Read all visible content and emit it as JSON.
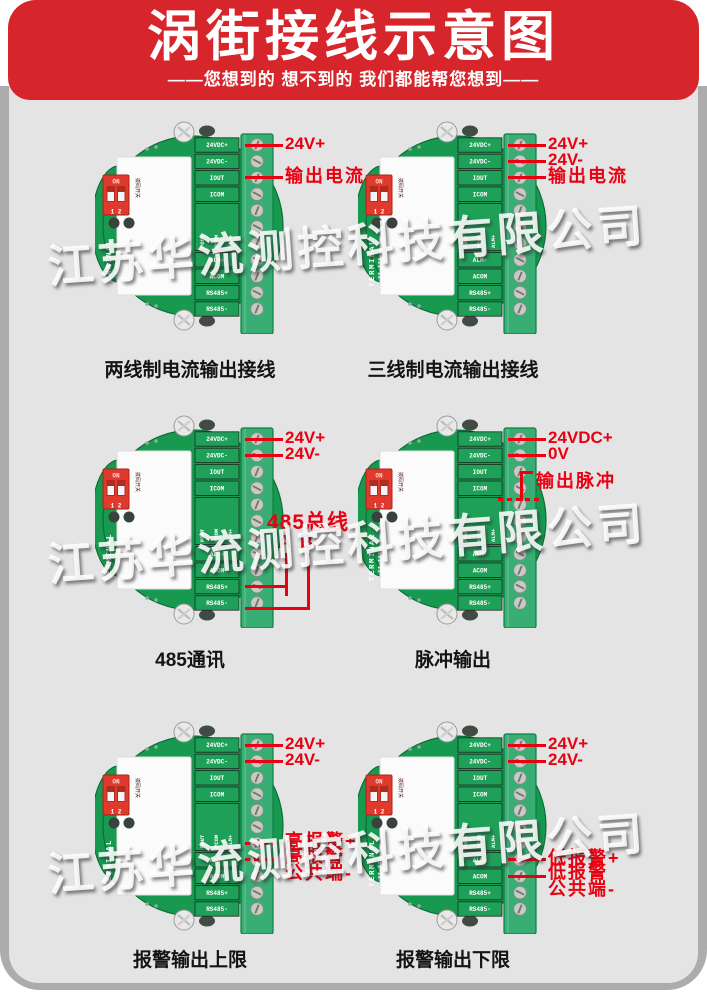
{
  "header": {
    "title": "涡街接线示意图",
    "subtitle": "——您想到的 想不到的 我们都能帮您想到——"
  },
  "watermark": {
    "text": "江苏华流测控科技有限公司"
  },
  "board_common": {
    "terminals": [
      "24VDC+",
      "24VDC-",
      "IOUT",
      "ICOM",
      "POUT",
      "PCOM",
      "ALM+",
      "ALM-",
      "ACOM",
      "RS485+",
      "RS485-"
    ],
    "dip_switch": {
      "on_label": "ON",
      "positions": "1 2",
      "side_label": "拨码开关"
    },
    "side_text": "TERMINAL",
    "side_text2": "II-III"
  },
  "boards": [
    {
      "caption": "两线制电流输出接线",
      "annotations": [
        {
          "type": "wire",
          "text": "24V+",
          "terminal": "24VDC+"
        },
        {
          "type": "wire",
          "text": "输出电流",
          "terminal": "IOUT",
          "cjk": true
        }
      ]
    },
    {
      "caption": "三线制电流输出接线",
      "annotations": [
        {
          "type": "wire",
          "text": "24V+",
          "terminal": "24VDC+"
        },
        {
          "type": "wire",
          "text": "24V-",
          "terminal": "24VDC-"
        },
        {
          "type": "wire",
          "text": "输出电流",
          "terminal": "IOUT",
          "cjk": true
        }
      ]
    },
    {
      "caption": "485通讯",
      "annotations": [
        {
          "type": "wire",
          "text": "24V+",
          "terminal": "24VDC+"
        },
        {
          "type": "wire",
          "text": "24V-",
          "terminal": "24VDC-"
        },
        {
          "type": "bus",
          "title": "485总线",
          "wire_a": "A",
          "wire_b": "B",
          "terminal_a": "RS485+",
          "terminal_b": "RS485-"
        }
      ]
    },
    {
      "caption": "脉冲输出",
      "annotations": [
        {
          "type": "wire",
          "text": "24VDC+",
          "terminal": "24VDC+"
        },
        {
          "type": "wire",
          "text": "0V",
          "terminal": "24VDC-"
        },
        {
          "type": "bracket",
          "text": "输出脉冲",
          "terminal": "POUT",
          "cjk": true
        }
      ]
    },
    {
      "caption": "报警输出上限",
      "annotations": [
        {
          "type": "wire",
          "text": "24V+",
          "terminal": "24VDC+"
        },
        {
          "type": "wire",
          "text": "24V-",
          "terminal": "24VDC-"
        },
        {
          "type": "wire",
          "text": "高报警+",
          "terminal": "ALM+",
          "dashed": true,
          "cjk": true
        },
        {
          "type": "wire",
          "text": "高报警",
          "text2": "公共端-",
          "terminal": "ALM-",
          "dashed": true,
          "cjk": true
        }
      ]
    },
    {
      "caption": "报警输出下限",
      "annotations": [
        {
          "type": "wire",
          "text": "24V+",
          "terminal": "24VDC+"
        },
        {
          "type": "wire",
          "text": "24V-",
          "terminal": "24VDC-"
        },
        {
          "type": "wire",
          "text": "低报警+",
          "terminal": "ALM-",
          "cjk": true
        },
        {
          "type": "wire",
          "text": "低报警",
          "text2": "公共端-",
          "terminal": "ACOM",
          "cjk": true
        }
      ]
    }
  ],
  "colors": {
    "header_red": "#d6252b",
    "annotation_red": "#ea0011",
    "board_green": "#179a50",
    "terminal_block_green": "#38ad74",
    "dip_red": "#e03a2e",
    "panel_gray": "#e4e4e4",
    "frame_gray": "#acacac"
  }
}
